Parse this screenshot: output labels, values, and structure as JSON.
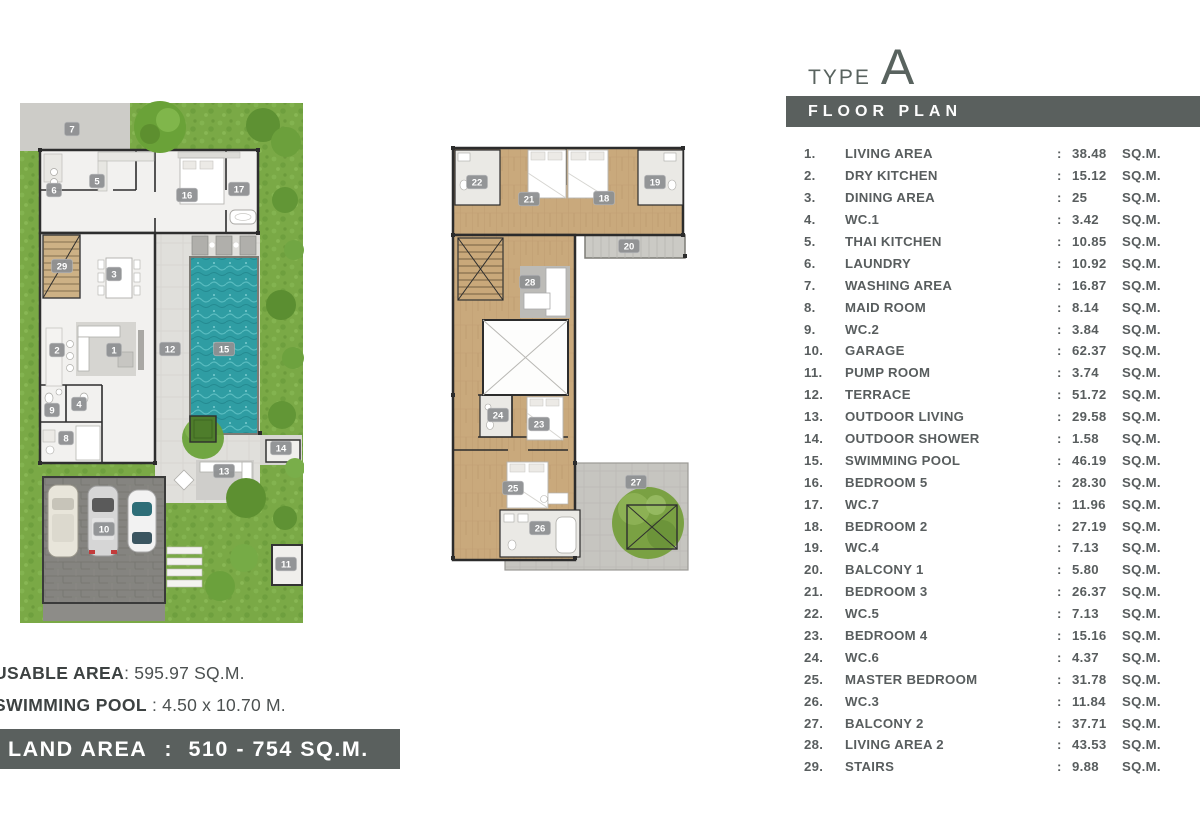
{
  "header": {
    "type_label": "TYPE",
    "type_letter": "A",
    "section_title": "FLOOR PLAN"
  },
  "room_list": {
    "colon": ":",
    "area_unit": "SQ.M.",
    "rooms": [
      {
        "no": "1.",
        "name": "LIVING AREA",
        "area": "38.48"
      },
      {
        "no": "2.",
        "name": "DRY KITCHEN",
        "area": "15.12"
      },
      {
        "no": "3.",
        "name": "DINING AREA",
        "area": "25"
      },
      {
        "no": "4.",
        "name": "WC.1",
        "area": "3.42"
      },
      {
        "no": "5.",
        "name": "THAI KITCHEN",
        "area": "10.85"
      },
      {
        "no": "6.",
        "name": "LAUNDRY",
        "area": "10.92"
      },
      {
        "no": "7.",
        "name": "WASHING AREA",
        "area": "16.87"
      },
      {
        "no": "8.",
        "name": "MAID ROOM",
        "area": "8.14"
      },
      {
        "no": "9.",
        "name": "WC.2",
        "area": "3.84"
      },
      {
        "no": "10.",
        "name": "GARAGE",
        "area": "62.37"
      },
      {
        "no": "11.",
        "name": "PUMP ROOM",
        "area": "3.74"
      },
      {
        "no": "12.",
        "name": "TERRACE",
        "area": "51.72"
      },
      {
        "no": "13.",
        "name": "OUTDOOR LIVING",
        "area": "29.58"
      },
      {
        "no": "14.",
        "name": "OUTDOOR SHOWER",
        "area": "1.58"
      },
      {
        "no": "15.",
        "name": "SWIMMING POOL",
        "area": "46.19"
      },
      {
        "no": "16.",
        "name": "BEDROOM 5",
        "area": "28.30"
      },
      {
        "no": "17.",
        "name": "WC.7",
        "area": "11.96"
      },
      {
        "no": "18.",
        "name": "BEDROOM 2",
        "area": "27.19"
      },
      {
        "no": "19.",
        "name": "WC.4",
        "area": "7.13"
      },
      {
        "no": "20.",
        "name": "BALCONY 1",
        "area": "5.80"
      },
      {
        "no": "21.",
        "name": "BEDROOM 3",
        "area": "26.37"
      },
      {
        "no": "22.",
        "name": "WC.5",
        "area": "7.13"
      },
      {
        "no": "23.",
        "name": "BEDROOM 4",
        "area": "15.16"
      },
      {
        "no": "24.",
        "name": "WC.6",
        "area": "4.37"
      },
      {
        "no": "25.",
        "name": "MASTER BEDROOM",
        "area": "31.78"
      },
      {
        "no": "26.",
        "name": "WC.3",
        "area": "11.84"
      },
      {
        "no": "27.",
        "name": "BALCONY 2",
        "area": "37.71"
      },
      {
        "no": "28.",
        "name": "LIVING AREA 2",
        "area": "43.53"
      },
      {
        "no": "29.",
        "name": "STAIRS",
        "area": "9.88"
      }
    ]
  },
  "footer": {
    "usable_label": "USABLE AREA",
    "usable_rest": ": 595.97 SQ.M.",
    "pool_label": "SWIMMING POOL",
    "pool_rest": " : 4.50 x 10.70 M.",
    "land_label": "LAND AREA",
    "land_colon": ":",
    "land_value": "510 - 754 SQ.M."
  },
  "plans": {
    "ground_floor_badges": [
      "7",
      "6",
      "5",
      "16",
      "17",
      "29",
      "3",
      "2",
      "1",
      "12",
      "15",
      "9",
      "4",
      "8",
      "13",
      "14",
      "10",
      "11"
    ],
    "second_floor_badges": [
      "22",
      "21",
      "18",
      "19",
      "20",
      "28",
      "24",
      "23",
      "25",
      "26",
      "27"
    ]
  },
  "colors": {
    "accent_bar": "#5a605e",
    "pool": "#2f9da3",
    "grass": "#7aa946",
    "wood": "#c9a97c",
    "badge": "#8f9193"
  }
}
